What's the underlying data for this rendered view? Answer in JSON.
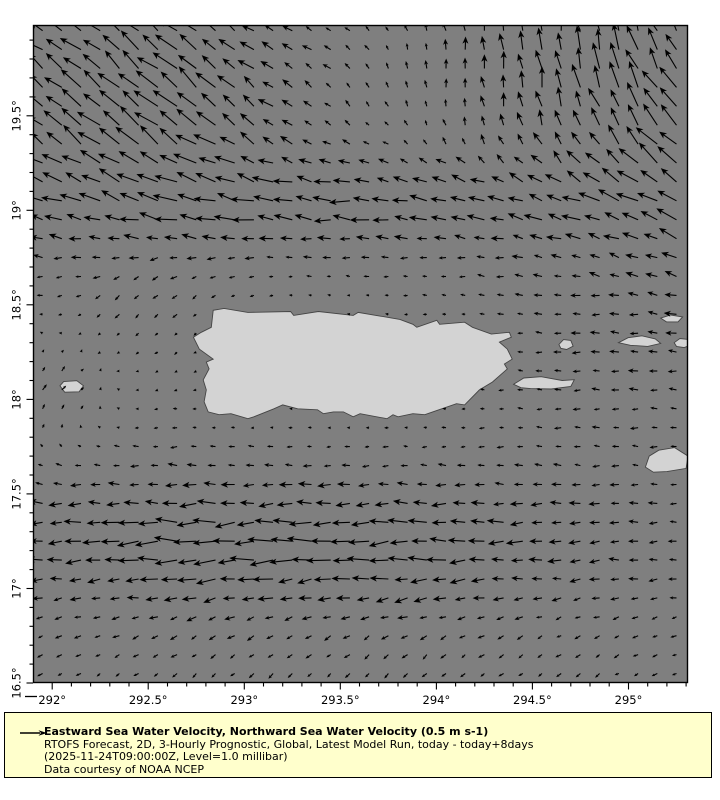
{
  "legend": {
    "title": "Eastward Sea Water Velocity, Northward Sea Water Velocity (0.5 m s-1)",
    "subtitle": "RTOFS Forecast, 2D, 3-Hourly Prognostic, Global, Latest Model Run, today - today+8days",
    "run_info": "(2025-11-24T09:00:00Z, Level=1.0 millibar)",
    "credit": "Data courtesy of NOAA NCEP"
  },
  "chart_data": {
    "type": "quiver",
    "title": "Eastward Sea Water Velocity, Northward Sea Water Velocity",
    "reference_vector": {
      "value": 0.5,
      "unit": "m s-1",
      "length_px": 22
    },
    "x_axis": {
      "ticks": [
        292,
        292.5,
        293,
        293.5,
        294,
        294.5,
        295
      ],
      "unit": "°",
      "minor_step": 0.1,
      "range": [
        291.9,
        295.31
      ]
    },
    "y_axis": {
      "ticks": [
        16.5,
        17,
        17.5,
        18,
        18.5,
        19,
        19.5
      ],
      "unit": "°",
      "minor_step": 0.1,
      "range": [
        16.5,
        19.98
      ]
    },
    "bounds": {
      "lon_min": 291.9,
      "lon_max": 295.31,
      "lat_min": 16.5,
      "lat_max": 19.98
    },
    "grid": {
      "lon_start": 291.95,
      "lon_step": 0.1,
      "cols": 34,
      "lat_start": 16.55,
      "lat_step": 0.1,
      "rows": 35
    },
    "px_per_unit": 44,
    "base_flow": {
      "u": -0.13,
      "v": 0.005
    },
    "flow_features": [
      {
        "cx": 292.45,
        "cy": 19.6,
        "sx": 0.55,
        "sy": 0.45,
        "u": -0.35,
        "v": 0.4
      },
      {
        "cx": 293.6,
        "cy": 19.02,
        "sx": 1.3,
        "sy": 0.17,
        "u": -0.32,
        "v": 0.0
      },
      {
        "cx": 294.8,
        "cy": 19.85,
        "sx": 0.55,
        "sy": 0.5,
        "u": 0.05,
        "v": 0.45
      },
      {
        "cx": 295.45,
        "cy": 19.4,
        "sx": 0.4,
        "sy": 0.45,
        "u": -0.35,
        "v": 0.22
      },
      {
        "cx": 293.2,
        "cy": 17.25,
        "sx": 1.1,
        "sy": 0.25,
        "u": -0.4,
        "v": -0.02
      },
      {
        "cx": 292.5,
        "cy": 18.52,
        "sx": 0.35,
        "sy": 0.28,
        "u": 0.02,
        "v": -0.16
      },
      {
        "cx": 292.0,
        "cy": 18.05,
        "sx": 0.25,
        "sy": 0.22,
        "u": 0.25,
        "v": 0.14
      },
      {
        "cx": 293.5,
        "cy": 16.6,
        "sx": 1.6,
        "sy": 0.3,
        "u": 0.04,
        "v": -0.1
      },
      {
        "cx": 293.95,
        "cy": 19.65,
        "sx": 0.45,
        "sy": 0.35,
        "u": 0.1,
        "v": 0.03
      },
      {
        "cx": 294.9,
        "cy": 18.35,
        "sx": 0.7,
        "sy": 0.35,
        "u": -0.12,
        "v": 0.0
      }
    ],
    "damp_zones": [
      {
        "cx": 293.55,
        "cy": 18.2,
        "sx": 0.8,
        "sy": 0.38,
        "amount": 0.75
      }
    ],
    "islands": {
      "puerto_rico": [
        [
          292.828,
          18.381
        ],
        [
          292.838,
          18.471
        ],
        [
          292.895,
          18.481
        ],
        [
          293.019,
          18.46
        ],
        [
          293.241,
          18.465
        ],
        [
          293.257,
          18.444
        ],
        [
          293.386,
          18.465
        ],
        [
          293.567,
          18.444
        ],
        [
          293.593,
          18.46
        ],
        [
          293.81,
          18.423
        ],
        [
          293.878,
          18.397
        ],
        [
          293.898,
          18.381
        ],
        [
          294.002,
          18.418
        ],
        [
          294.017,
          18.397
        ],
        [
          294.147,
          18.408
        ],
        [
          294.188,
          18.381
        ],
        [
          294.286,
          18.345
        ],
        [
          294.38,
          18.355
        ],
        [
          294.39,
          18.329
        ],
        [
          294.328,
          18.303
        ],
        [
          294.369,
          18.266
        ],
        [
          294.395,
          18.213
        ],
        [
          294.354,
          18.187
        ],
        [
          294.369,
          18.161
        ],
        [
          294.292,
          18.092
        ],
        [
          294.224,
          18.05
        ],
        [
          294.147,
          17.971
        ],
        [
          294.105,
          17.977
        ],
        [
          293.981,
          17.934
        ],
        [
          293.94,
          17.919
        ],
        [
          293.878,
          17.924
        ],
        [
          293.8,
          17.908
        ],
        [
          293.774,
          17.919
        ],
        [
          293.743,
          17.898
        ],
        [
          293.603,
          17.924
        ],
        [
          293.567,
          17.908
        ],
        [
          293.516,
          17.934
        ],
        [
          293.464,
          17.934
        ],
        [
          293.412,
          17.924
        ],
        [
          293.381,
          17.945
        ],
        [
          293.278,
          17.95
        ],
        [
          293.2,
          17.971
        ],
        [
          293.154,
          17.95
        ],
        [
          293.05,
          17.908
        ],
        [
          293.019,
          17.898
        ],
        [
          292.931,
          17.924
        ],
        [
          292.869,
          17.919
        ],
        [
          292.812,
          17.934
        ],
        [
          292.791,
          17.987
        ],
        [
          292.802,
          18.05
        ],
        [
          292.786,
          18.103
        ],
        [
          292.817,
          18.161
        ],
        [
          292.802,
          18.197
        ],
        [
          292.838,
          18.213
        ],
        [
          292.766,
          18.266
        ],
        [
          292.735,
          18.329
        ],
        [
          292.776,
          18.355
        ]
      ],
      "mona": [
        [
          292.04,
          18.072
        ],
        [
          292.06,
          18.094
        ],
        [
          292.128,
          18.099
        ],
        [
          292.163,
          18.072
        ],
        [
          292.14,
          18.04
        ],
        [
          292.065,
          18.038
        ]
      ],
      "vieques": [
        [
          294.402,
          18.08
        ],
        [
          294.455,
          18.113
        ],
        [
          294.545,
          18.12
        ],
        [
          294.655,
          18.1
        ],
        [
          294.718,
          18.104
        ],
        [
          294.7,
          18.068
        ],
        [
          294.598,
          18.055
        ],
        [
          294.49,
          18.057
        ],
        [
          294.44,
          18.062
        ]
      ],
      "culebra": [
        [
          294.638,
          18.29
        ],
        [
          294.662,
          18.316
        ],
        [
          294.7,
          18.312
        ],
        [
          294.712,
          18.281
        ],
        [
          294.678,
          18.264
        ],
        [
          294.648,
          18.27
        ]
      ],
      "st_thomas": [
        [
          294.948,
          18.3
        ],
        [
          294.998,
          18.326
        ],
        [
          295.07,
          18.336
        ],
        [
          295.14,
          18.32
        ],
        [
          295.168,
          18.296
        ],
        [
          295.1,
          18.28
        ],
        [
          295.01,
          18.286
        ]
      ],
      "tortola": [
        [
          295.238,
          18.3
        ],
        [
          295.268,
          18.322
        ],
        [
          295.32,
          18.316
        ],
        [
          295.332,
          18.29
        ],
        [
          295.29,
          18.274
        ],
        [
          295.25,
          18.28
        ]
      ],
      "north_cay": [
        [
          295.168,
          18.43
        ],
        [
          295.22,
          18.446
        ],
        [
          295.282,
          18.436
        ],
        [
          295.258,
          18.41
        ],
        [
          295.198,
          18.41
        ]
      ],
      "st_croix": [
        [
          295.088,
          17.642
        ],
        [
          295.108,
          17.7
        ],
        [
          295.158,
          17.731
        ],
        [
          295.24,
          17.745
        ],
        [
          295.31,
          17.7
        ],
        [
          295.3,
          17.635
        ],
        [
          295.2,
          17.618
        ],
        [
          295.13,
          17.615
        ]
      ]
    },
    "colors": {
      "ocean": "#7f7f7f",
      "land": "#d3d3d3",
      "coast": "#454545",
      "arrow": "#000000",
      "frame": "#000000",
      "legend_bg": "#ffffcc",
      "text": "#000000"
    }
  }
}
